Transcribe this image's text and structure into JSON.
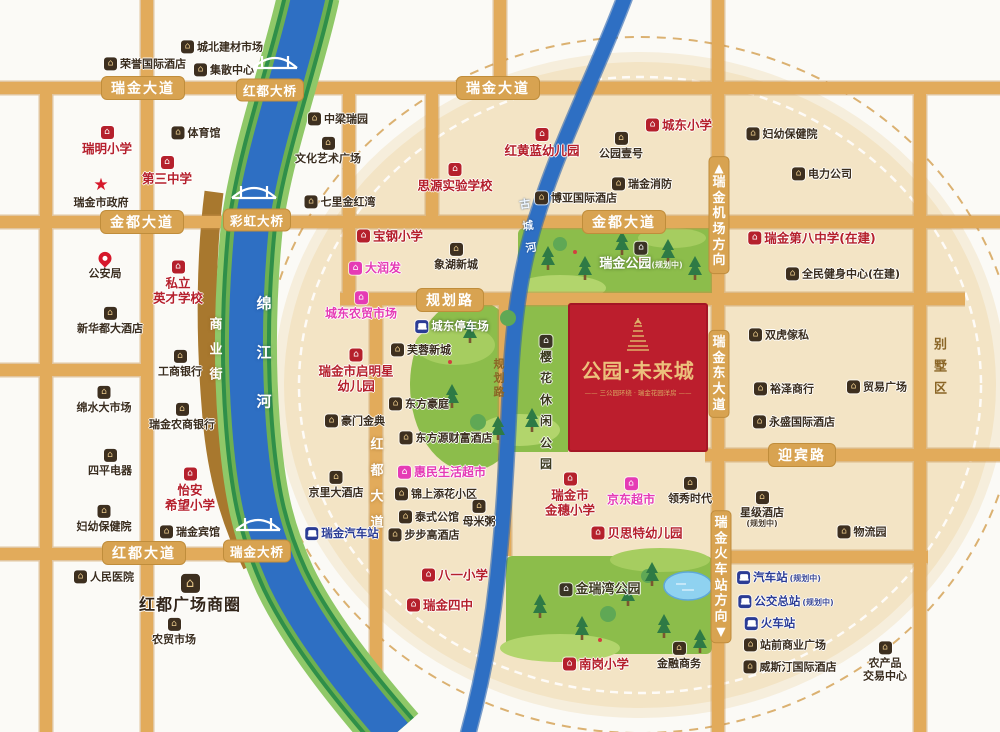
{
  "project": {
    "name": "公园·未来城",
    "tagline": "—— 三公园环绕 · 瑞金花园洋房 ——",
    "block_color": "#bc1e2d",
    "text_color": "#ecc07c"
  },
  "colors": {
    "road": "#e2ab5b",
    "river": "#2e6fc3",
    "river_bank": "#2f8f49",
    "park": "#8cbd4b",
    "highlight_circle": "#f3e4c5",
    "school_red": "#b5202c",
    "shop_magenta": "#e53bb5",
    "transit_blue": "#2b3c95",
    "dark_text": "#3a2d1e",
    "badge": "#d8a351",
    "commercial_street": "#a8782e"
  },
  "badges": [
    {
      "label": "瑞金大道",
      "x": 143,
      "y": 88
    },
    {
      "label": "瑞金大道",
      "x": 498,
      "y": 88
    },
    {
      "label": "金都大道",
      "x": 142,
      "y": 222
    },
    {
      "label": "金都大道",
      "x": 624,
      "y": 222
    },
    {
      "label": "规划路",
      "x": 450,
      "y": 300
    },
    {
      "label": "红都大道",
      "x": 144,
      "y": 553
    },
    {
      "label": "迎宾路",
      "x": 802,
      "y": 455
    },
    {
      "label": "红都大桥",
      "x": 270,
      "y": 90,
      "kind": "bridge"
    },
    {
      "label": "彩虹大桥",
      "x": 257,
      "y": 220,
      "kind": "bridge"
    },
    {
      "label": "瑞金大桥",
      "x": 257,
      "y": 551,
      "kind": "bridge"
    }
  ],
  "vbadges": [
    {
      "label": "瑞金机场方向",
      "x": 719,
      "y": 215,
      "arrow": "▲"
    },
    {
      "label": "瑞金东大道",
      "x": 719,
      "y": 374
    },
    {
      "label": "瑞金火车站方向",
      "x": 721,
      "y": 577,
      "arrow": "▼"
    }
  ],
  "vtexts": [
    {
      "label": "红都大道",
      "x": 377,
      "y": 484,
      "gap": 13,
      "size": 13,
      "cls": "vt-white",
      "nm": "hongdu-avenue-vertical-name"
    },
    {
      "label": "商业街",
      "x": 216,
      "y": 350,
      "gap": 12,
      "size": 13,
      "cls": "vt-white",
      "nm": "commercial-street-name"
    },
    {
      "label": "绵江河",
      "x": 264,
      "y": 353,
      "gap": 34,
      "size": 15,
      "cls": "vt-river",
      "nm": "mianjiang-river-name"
    },
    {
      "label": "古城河",
      "x": 528,
      "y": 226,
      "gap": 11,
      "size": 11,
      "cls": "vt-river-sm",
      "rot": -8,
      "nm": "gucheng-river-name"
    },
    {
      "label": "规划路",
      "x": 499,
      "y": 378,
      "gap": 3,
      "size": 11,
      "cls": "vt-brown",
      "nm": "planned-road-vertical-name"
    },
    {
      "label": "别墅区",
      "x": 941,
      "y": 367,
      "gap": 9,
      "size": 13,
      "cls": "vt-brown-lg",
      "nm": "villa-district-name"
    }
  ],
  "pois": [
    {
      "n": [
        "城北建材市场"
      ],
      "x": 222,
      "y": 47,
      "t": "dark",
      "l": "row"
    },
    {
      "n": [
        "荣誉国际酒店"
      ],
      "x": 145,
      "y": 64,
      "t": "dark",
      "l": "row"
    },
    {
      "n": [
        "集散中心"
      ],
      "x": 224,
      "y": 70,
      "t": "dark",
      "l": "row"
    },
    {
      "n": [
        "体育馆"
      ],
      "x": 196,
      "y": 133,
      "t": "dark",
      "l": "row"
    },
    {
      "n": [
        "瑞明小学"
      ],
      "x": 107,
      "y": 141,
      "t": "school",
      "l": "col"
    },
    {
      "n": [
        "第三中学"
      ],
      "x": 167,
      "y": 171,
      "t": "school",
      "l": "col"
    },
    {
      "n": [
        "瑞金市政府"
      ],
      "x": 101,
      "y": 193,
      "t": "gov",
      "l": "col"
    },
    {
      "n": [
        "中梁瑞园"
      ],
      "x": 338,
      "y": 119,
      "t": "dark",
      "l": "row"
    },
    {
      "n": [
        "文化艺术广场"
      ],
      "x": 328,
      "y": 151,
      "t": "dark",
      "l": "col"
    },
    {
      "n": [
        "七里金红湾"
      ],
      "x": 340,
      "y": 202,
      "t": "dark",
      "l": "row"
    },
    {
      "n": [
        "公安局"
      ],
      "x": 105,
      "y": 266,
      "t": "police",
      "l": "col"
    },
    {
      "n": [
        "私立",
        "英才学校"
      ],
      "x": 178,
      "y": 283,
      "t": "school",
      "l": "col"
    },
    {
      "n": [
        "新华都大酒店"
      ],
      "x": 110,
      "y": 321,
      "t": "dark",
      "l": "col"
    },
    {
      "n": [
        "工商银行"
      ],
      "x": 180,
      "y": 364,
      "t": "dark",
      "l": "col"
    },
    {
      "n": [
        "绵水大市场"
      ],
      "x": 104,
      "y": 400,
      "t": "dark",
      "l": "col"
    },
    {
      "n": [
        "瑞金农商银行"
      ],
      "x": 182,
      "y": 417,
      "t": "dark",
      "l": "col"
    },
    {
      "n": [
        "四平电器"
      ],
      "x": 110,
      "y": 463,
      "t": "dark",
      "l": "col"
    },
    {
      "n": [
        "怡安",
        "希望小学"
      ],
      "x": 190,
      "y": 490,
      "t": "school",
      "l": "col"
    },
    {
      "n": [
        "妇幼保健院"
      ],
      "x": 104,
      "y": 519,
      "t": "dark",
      "l": "col"
    },
    {
      "n": [
        "瑞金宾馆"
      ],
      "x": 190,
      "y": 532,
      "t": "dark",
      "l": "row"
    },
    {
      "n": [
        "人民医院"
      ],
      "x": 104,
      "y": 577,
      "t": "dark",
      "l": "row"
    },
    {
      "n": [
        "红都广场商圈"
      ],
      "x": 190,
      "y": 594,
      "t": "mall",
      "l": "col"
    },
    {
      "n": [
        "农贸市场"
      ],
      "x": 174,
      "y": 632,
      "t": "dark",
      "l": "col"
    },
    {
      "n": [
        "京里大酒店"
      ],
      "x": 336,
      "y": 485,
      "t": "dark",
      "l": "col"
    },
    {
      "n": [
        "瑞金汽车站"
      ],
      "x": 342,
      "y": 534,
      "t": "transit",
      "l": "row"
    },
    {
      "n": [
        "思源实验学校"
      ],
      "x": 455,
      "y": 178,
      "t": "school",
      "l": "col"
    },
    {
      "n": [
        "宝钢小学"
      ],
      "x": 390,
      "y": 236,
      "t": "school",
      "l": "row"
    },
    {
      "n": [
        "大润发"
      ],
      "x": 375,
      "y": 268,
      "t": "shop",
      "l": "row"
    },
    {
      "n": [
        "城东农贸市场"
      ],
      "x": 361,
      "y": 306,
      "t": "shop",
      "l": "col"
    },
    {
      "n": [
        "瑞金市启明星",
        "幼儿园"
      ],
      "x": 356,
      "y": 371,
      "t": "school",
      "l": "col"
    },
    {
      "n": [
        "豪门金典"
      ],
      "x": 355,
      "y": 421,
      "t": "dark",
      "l": "row"
    },
    {
      "n": [
        "象湖新城"
      ],
      "x": 456,
      "y": 257,
      "t": "dark",
      "l": "col"
    },
    {
      "n": [
        "城东停车场"
      ],
      "x": 452,
      "y": 327,
      "t": "transitw",
      "l": "row"
    },
    {
      "n": [
        "芙蓉新城"
      ],
      "x": 421,
      "y": 350,
      "t": "dark",
      "l": "row"
    },
    {
      "n": [
        "东方豪庭"
      ],
      "x": 419,
      "y": 404,
      "t": "dark",
      "l": "row"
    },
    {
      "n": [
        "东方源财富酒店"
      ],
      "x": 446,
      "y": 438,
      "t": "dark",
      "l": "row"
    },
    {
      "n": [
        "惠民生活超市"
      ],
      "x": 442,
      "y": 472,
      "t": "shop",
      "l": "row"
    },
    {
      "n": [
        "锦上添花小区"
      ],
      "x": 436,
      "y": 494,
      "t": "dark",
      "l": "row"
    },
    {
      "n": [
        "泰式公馆"
      ],
      "x": 429,
      "y": 517,
      "t": "dark",
      "l": "row"
    },
    {
      "n": [
        "母米粥"
      ],
      "x": 479,
      "y": 514,
      "t": "dark",
      "l": "col"
    },
    {
      "n": [
        "步步高酒店"
      ],
      "x": 424,
      "y": 535,
      "t": "dark",
      "l": "row"
    },
    {
      "n": [
        "八一小学"
      ],
      "x": 455,
      "y": 575,
      "t": "school",
      "l": "row"
    },
    {
      "n": [
        "瑞金四中"
      ],
      "x": 440,
      "y": 605,
      "t": "school",
      "l": "row"
    },
    {
      "n": [
        "南岗小学"
      ],
      "x": 596,
      "y": 664,
      "t": "school",
      "l": "row"
    },
    {
      "n": [
        "金融商务"
      ],
      "x": 679,
      "y": 656,
      "t": "dark",
      "l": "col"
    },
    {
      "n": [
        "红黄蓝幼儿园"
      ],
      "x": 542,
      "y": 143,
      "t": "school",
      "l": "col"
    },
    {
      "n": [
        "公园壹号"
      ],
      "x": 621,
      "y": 146,
      "t": "dark",
      "l": "col"
    },
    {
      "n": [
        "瑞金消防"
      ],
      "x": 642,
      "y": 184,
      "t": "dark",
      "l": "row"
    },
    {
      "n": [
        "博亚国际酒店"
      ],
      "x": 576,
      "y": 198,
      "t": "dark",
      "l": "row"
    },
    {
      "n": [
        "城东小学"
      ],
      "x": 679,
      "y": 125,
      "t": "school",
      "l": "row"
    },
    {
      "n": [
        "妇幼保健院"
      ],
      "x": 782,
      "y": 134,
      "t": "dark",
      "l": "row"
    },
    {
      "n": [
        "电力公司"
      ],
      "x": 822,
      "y": 174,
      "t": "dark",
      "l": "row"
    },
    {
      "n": [
        "瑞金第八中学(在建)"
      ],
      "x": 812,
      "y": 238,
      "t": "school",
      "l": "row"
    },
    {
      "n": [
        "全民健身中心(在建)"
      ],
      "x": 843,
      "y": 274,
      "t": "dark",
      "l": "row"
    },
    {
      "n": [
        "双虎傢私"
      ],
      "x": 779,
      "y": 335,
      "t": "dark",
      "l": "row"
    },
    {
      "n": [
        "裕泽商行"
      ],
      "x": 784,
      "y": 389,
      "t": "dark",
      "l": "row"
    },
    {
      "n": [
        "贸易广场"
      ],
      "x": 877,
      "y": 387,
      "t": "dark",
      "l": "row"
    },
    {
      "n": [
        "永盛国际酒店"
      ],
      "x": 794,
      "y": 422,
      "t": "dark",
      "l": "row"
    },
    {
      "n": [
        "星级酒店"
      ],
      "x": 762,
      "y": 510,
      "t": "dark",
      "l": "col",
      "sub": "(规划中)"
    },
    {
      "n": [
        "物流园"
      ],
      "x": 862,
      "y": 532,
      "t": "dark",
      "l": "row"
    },
    {
      "n": [
        "领秀时代"
      ],
      "x": 690,
      "y": 491,
      "t": "dark",
      "l": "col"
    },
    {
      "n": [
        "瑞金市",
        "金穗小学"
      ],
      "x": 570,
      "y": 495,
      "t": "school",
      "l": "col"
    },
    {
      "n": [
        "京东超市"
      ],
      "x": 631,
      "y": 492,
      "t": "shop",
      "l": "col"
    },
    {
      "n": [
        "贝思特幼儿园"
      ],
      "x": 637,
      "y": 533,
      "t": "school",
      "l": "row"
    },
    {
      "n": [
        "汽车站"
      ],
      "x": 779,
      "y": 578,
      "t": "transit",
      "l": "row",
      "sub": "(规划中)",
      "subInline": true
    },
    {
      "n": [
        "公交总站"
      ],
      "x": 786,
      "y": 602,
      "t": "transit",
      "l": "row",
      "sub": "(规划中)",
      "subInline": true
    },
    {
      "n": [
        "火车站"
      ],
      "x": 770,
      "y": 624,
      "t": "transit",
      "l": "row"
    },
    {
      "n": [
        "站前商业广场"
      ],
      "x": 785,
      "y": 645,
      "t": "dark",
      "l": "row"
    },
    {
      "n": [
        "威斯汀国际酒店"
      ],
      "x": 790,
      "y": 667,
      "t": "dark",
      "l": "row"
    },
    {
      "n": [
        "农产品",
        "交易中心"
      ],
      "x": 885,
      "y": 662,
      "t": "dark",
      "l": "col"
    },
    {
      "n": [
        "瑞金公园"
      ],
      "x": 641,
      "y": 257,
      "t": "parkname",
      "l": "col",
      "sub": "(规划中)",
      "subInline": true
    },
    {
      "n": [
        "金瑞湾公园"
      ],
      "x": 600,
      "y": 590,
      "t": "parkband",
      "l": "row"
    },
    {
      "n": [
        "樱花休闲公园"
      ],
      "x": 546,
      "y": 403,
      "t": "parkv",
      "l": "vcol"
    }
  ]
}
